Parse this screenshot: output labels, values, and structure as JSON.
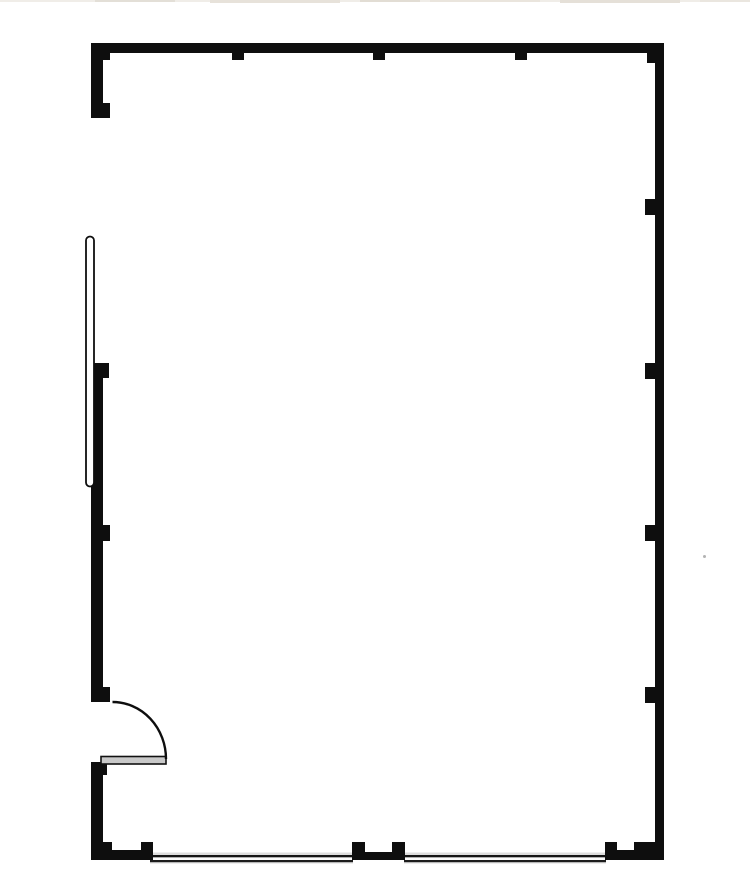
{
  "scene": {
    "description": "architectural-floor-plan-empty-room",
    "width": 750,
    "height": 896,
    "background": "#ffffff",
    "palette": {
      "wall_black": "#0e0e0e",
      "window_halo_gray": "#dcdcdc",
      "window_glass_white": "#fafafa",
      "door_leaf_gray": "#c9c9c9",
      "panel_white": "#ffffff",
      "scan_artifact_beige": "#e7e2da",
      "speck_gray": "#b3b3b3"
    },
    "layers": [
      {
        "name": "top-edge-artifact",
        "shapes": [
          {
            "x": 0,
            "y": 0,
            "w": 750,
            "h": 2,
            "fill": "#f0ede8"
          },
          {
            "x": 95,
            "y": 0,
            "w": 80,
            "h": 2,
            "fill": "#e3dfd7"
          },
          {
            "x": 210,
            "y": 0,
            "w": 130,
            "h": 3,
            "fill": "#e7e2da"
          },
          {
            "x": 360,
            "y": 0,
            "w": 60,
            "h": 2,
            "fill": "#e2ddd4"
          },
          {
            "x": 430,
            "y": 0,
            "w": 110,
            "h": 2,
            "fill": "#eae5dd"
          },
          {
            "x": 560,
            "y": 0,
            "w": 120,
            "h": 3,
            "fill": "#e5e0d8"
          },
          {
            "x": 700,
            "y": 0,
            "w": 50,
            "h": 2,
            "fill": "#eae6df"
          }
        ]
      },
      {
        "name": "bottom-window-left",
        "shapes": [
          {
            "x": 150,
            "y": 852.5,
            "w": 203,
            "h": 11,
            "fill": "#dcdcdc"
          },
          {
            "x": 150,
            "y": 855,
            "w": 203,
            "h": 2.4,
            "fill": "#141414"
          },
          {
            "x": 150,
            "y": 857.4,
            "w": 203,
            "h": 2.6,
            "fill": "#fafafa"
          },
          {
            "x": 150,
            "y": 860,
            "w": 203,
            "h": 2.2,
            "fill": "#1c1c1c"
          }
        ]
      },
      {
        "name": "bottom-window-right",
        "shapes": [
          {
            "x": 404,
            "y": 852.5,
            "w": 202,
            "h": 11,
            "fill": "#dcdcdc"
          },
          {
            "x": 404,
            "y": 855,
            "w": 202,
            "h": 2.4,
            "fill": "#141414"
          },
          {
            "x": 404,
            "y": 857.4,
            "w": 202,
            "h": 2.6,
            "fill": "#fafafa"
          },
          {
            "x": 404,
            "y": 860,
            "w": 202,
            "h": 2.2,
            "fill": "#1c1c1c"
          }
        ]
      },
      {
        "name": "wall-segment",
        "shapes": [
          {
            "x": 91,
            "y": 43,
            "w": 573,
            "h": 10,
            "fill": "#0e0e0e"
          },
          {
            "x": 655,
            "y": 43,
            "w": 9,
            "h": 817,
            "fill": "#0e0e0e"
          },
          {
            "x": 91,
            "y": 43,
            "w": 12,
            "h": 75,
            "fill": "#0e0e0e"
          },
          {
            "x": 91,
            "y": 363,
            "w": 12,
            "h": 339,
            "fill": "#0e0e0e"
          },
          {
            "x": 91,
            "y": 762,
            "w": 12,
            "h": 98,
            "fill": "#0e0e0e"
          },
          {
            "x": 91,
            "y": 850,
            "w": 62,
            "h": 10,
            "fill": "#0e0e0e"
          },
          {
            "x": 352,
            "y": 852,
            "w": 53,
            "h": 8,
            "fill": "#0e0e0e"
          },
          {
            "x": 605,
            "y": 850,
            "w": 59,
            "h": 10,
            "fill": "#0e0e0e"
          }
        ]
      },
      {
        "name": "pilaster",
        "shapes": [
          {
            "x": 102,
            "y": 53,
            "w": 8,
            "h": 7,
            "fill": "#0e0e0e"
          },
          {
            "x": 232,
            "y": 53,
            "w": 12,
            "h": 7,
            "fill": "#0e0e0e"
          },
          {
            "x": 373,
            "y": 53,
            "w": 12,
            "h": 7,
            "fill": "#0e0e0e"
          },
          {
            "x": 515,
            "y": 53,
            "w": 12,
            "h": 7,
            "fill": "#0e0e0e"
          },
          {
            "x": 647,
            "y": 53,
            "w": 8,
            "h": 10,
            "fill": "#0e0e0e"
          },
          {
            "x": 91,
            "y": 103,
            "w": 19,
            "h": 15,
            "fill": "#0e0e0e"
          },
          {
            "x": 91,
            "y": 363,
            "w": 18,
            "h": 15,
            "fill": "#0e0e0e"
          },
          {
            "x": 91,
            "y": 525,
            "w": 19,
            "h": 16,
            "fill": "#0e0e0e"
          },
          {
            "x": 91,
            "y": 687,
            "w": 19,
            "h": 15,
            "fill": "#0e0e0e"
          },
          {
            "x": 91,
            "y": 762,
            "w": 16,
            "h": 13,
            "fill": "#0e0e0e"
          },
          {
            "x": 91,
            "y": 842,
            "w": 21,
            "h": 18,
            "fill": "#0e0e0e"
          },
          {
            "x": 141,
            "y": 842,
            "w": 12,
            "h": 12,
            "fill": "#0e0e0e"
          },
          {
            "x": 645,
            "y": 199,
            "w": 19,
            "h": 16,
            "fill": "#0e0e0e"
          },
          {
            "x": 645,
            "y": 363,
            "w": 19,
            "h": 16,
            "fill": "#0e0e0e"
          },
          {
            "x": 645,
            "y": 525,
            "w": 19,
            "h": 16,
            "fill": "#0e0e0e"
          },
          {
            "x": 645,
            "y": 687,
            "w": 19,
            "h": 16,
            "fill": "#0e0e0e"
          },
          {
            "x": 645,
            "y": 842,
            "w": 19,
            "h": 18,
            "fill": "#0e0e0e"
          },
          {
            "x": 352,
            "y": 842,
            "w": 13,
            "h": 13,
            "fill": "#0e0e0e"
          },
          {
            "x": 392,
            "y": 842,
            "w": 13,
            "h": 13,
            "fill": "#0e0e0e"
          },
          {
            "x": 605,
            "y": 842,
            "w": 12,
            "h": 12,
            "fill": "#0e0e0e"
          },
          {
            "x": 634,
            "y": 842,
            "w": 13,
            "h": 12,
            "fill": "#0e0e0e"
          }
        ]
      },
      {
        "name": "left-sliding-panel",
        "shapes": [
          {
            "x": 86,
            "y": 236.5,
            "w": 8,
            "h": 250,
            "rx": 4,
            "fill": "#ffffff",
            "stroke": "#0e0e0e",
            "sw": 1.8
          }
        ]
      },
      {
        "name": "door-leaf",
        "shapes": [
          {
            "x": 101,
            "y": 756.5,
            "w": 65,
            "h": 7.5,
            "fill": "#c9c9c9",
            "stroke": "#111111",
            "sw": 1.6
          }
        ]
      },
      {
        "name": "door-swing-arc",
        "shapes": [
          {
            "d": "M 112.5 702 A 53.5 57 0 0 1 166 759",
            "fill": "none",
            "stroke": "#0e0e0e",
            "sw": 2.4
          }
        ]
      },
      {
        "name": "wall-speck",
        "shapes": [
          {
            "x": 703,
            "y": 555,
            "w": 3,
            "h": 3,
            "rx": 1.5,
            "fill": "#b3b3b3"
          }
        ]
      }
    ]
  }
}
